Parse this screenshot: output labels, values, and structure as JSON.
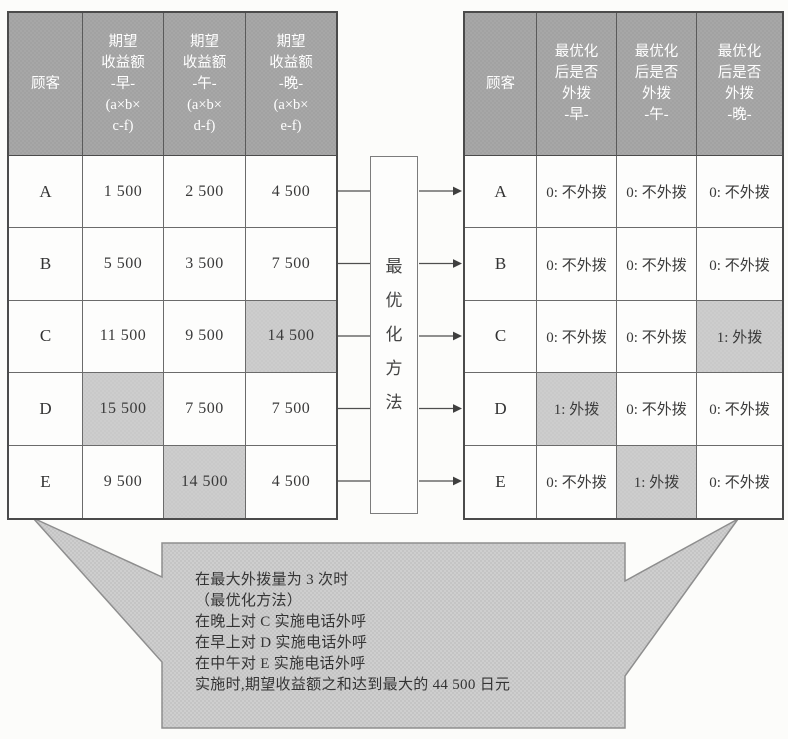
{
  "figure": {
    "left_table": {
      "corner_header": "顾客",
      "col_headers": [
        [
          "期望",
          "收益额",
          "-早-",
          "(a×b×",
          "c-f)"
        ],
        [
          "期望",
          "收益额",
          "-午-",
          "(a×b×",
          "d-f)"
        ],
        [
          "期望",
          "收益额",
          "-晚-",
          "(a×b×",
          "e-f)"
        ]
      ],
      "rows": [
        {
          "label": "A",
          "values": [
            "1 500",
            "2 500",
            "4 500"
          ],
          "highlight": -1
        },
        {
          "label": "B",
          "values": [
            "5 500",
            "3 500",
            "7 500"
          ],
          "highlight": -1
        },
        {
          "label": "C",
          "values": [
            "11 500",
            "9 500",
            "14 500"
          ],
          "highlight": 2
        },
        {
          "label": "D",
          "values": [
            "15 500",
            "7 500",
            "7 500"
          ],
          "highlight": 0
        },
        {
          "label": "E",
          "values": [
            "9 500",
            "14 500",
            "4 500"
          ],
          "highlight": 1
        }
      ]
    },
    "middle_box": {
      "label_chars": [
        "最",
        "优",
        "化",
        "方",
        "法"
      ]
    },
    "right_table": {
      "corner_header": "顾客",
      "col_headers": [
        [
          "最优化",
          "后是否",
          "外拨",
          "-早-"
        ],
        [
          "最优化",
          "后是否",
          "外拨",
          "-午-"
        ],
        [
          "最优化",
          "后是否",
          "外拨",
          "-晚-"
        ]
      ],
      "rows": [
        {
          "label": "A",
          "values": [
            "0: 不外拨",
            "0: 不外拨",
            "0: 不外拨"
          ],
          "highlight": -1
        },
        {
          "label": "B",
          "values": [
            "0: 不外拨",
            "0: 不外拨",
            "0: 不外拨"
          ],
          "highlight": -1
        },
        {
          "label": "C",
          "values": [
            "0: 不外拨",
            "0: 不外拨",
            "1: 外拨"
          ],
          "highlight": 2
        },
        {
          "label": "D",
          "values": [
            "1: 外拨",
            "0: 不外拨",
            "0: 不外拨"
          ],
          "highlight": 0
        },
        {
          "label": "E",
          "values": [
            "0: 不外拨",
            "1: 外拨",
            "0: 不外拨"
          ],
          "highlight": 1
        }
      ]
    },
    "callout": {
      "lines": [
        "在最大外拨量为 3 次时",
        "（最优化方法）",
        "在晚上对 C 实施电话外呼",
        "在早上对 D 实施电话外呼",
        "在中午对 E 实施电话外呼",
        "实施时,期望收益额之和达到最大的 44 500 日元"
      ]
    },
    "colors": {
      "header_bg": "#a7a7a7",
      "highlight_bg": "#cdcdcd",
      "callout_bg": "#cecece",
      "line": "#4e4e4e"
    }
  }
}
